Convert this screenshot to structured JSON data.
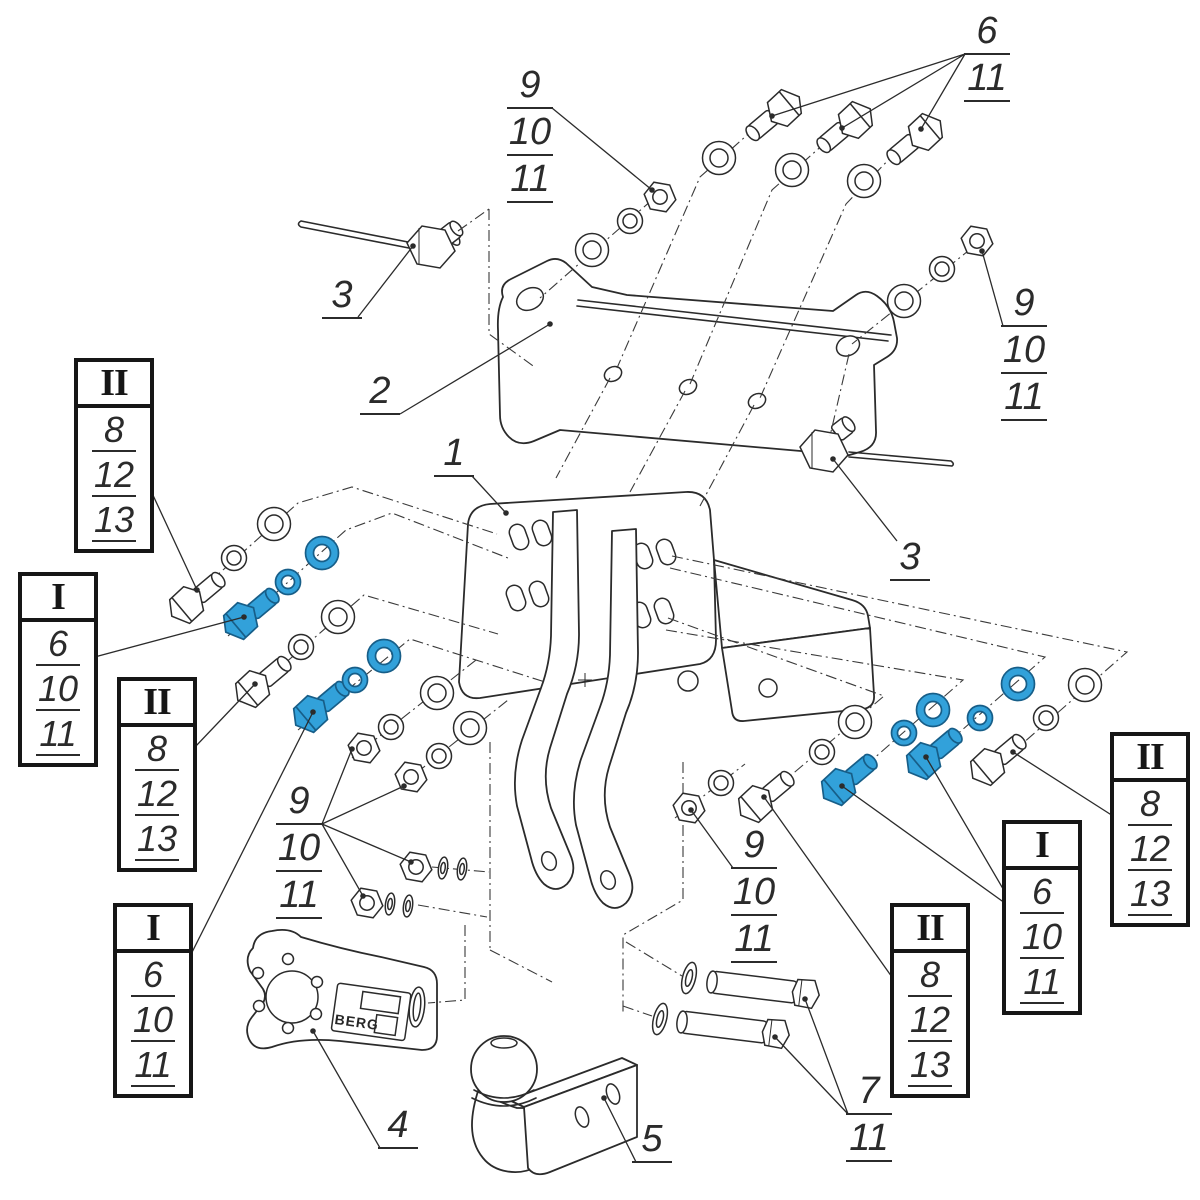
{
  "drawing": {
    "background": "#ffffff",
    "line_color": "#2b2b2b",
    "highlight_fill": "#32a1da",
    "highlight_stroke": "#175e88",
    "brand_label": "BERG"
  },
  "part_callouts": {
    "part1": "1",
    "part2": "2",
    "part3_left": "3",
    "part3_right": "3",
    "part4": "4",
    "part5": "5"
  },
  "stacked_labels": {
    "top_middle": {
      "items": [
        "9",
        "10",
        "11"
      ]
    },
    "top_right": {
      "items": [
        "6",
        "11"
      ]
    },
    "right_upper": {
      "items": [
        "9",
        "10",
        "11"
      ]
    },
    "center_left": {
      "items": [
        "9",
        "10",
        "11"
      ]
    },
    "bottom_center": {
      "items": [
        "9",
        "10",
        "11"
      ]
    },
    "bottom_right": {
      "items": [
        "7",
        "11"
      ]
    }
  },
  "callout_boxes": {
    "left_top": {
      "roman": "II",
      "items": [
        "8",
        "12",
        "13"
      ]
    },
    "left_mid": {
      "roman": "I",
      "items": [
        "6",
        "10",
        "11"
      ]
    },
    "left_lower": {
      "roman": "II",
      "items": [
        "8",
        "12",
        "13"
      ]
    },
    "left_bottom": {
      "roman": "I",
      "items": [
        "6",
        "10",
        "11"
      ]
    },
    "right_top": {
      "roman": "II",
      "items": [
        "8",
        "12",
        "13"
      ]
    },
    "right_mid": {
      "roman": "I",
      "items": [
        "6",
        "10",
        "11"
      ]
    },
    "right_bottom": {
      "roman": "II",
      "items": [
        "8",
        "12",
        "13"
      ]
    }
  }
}
